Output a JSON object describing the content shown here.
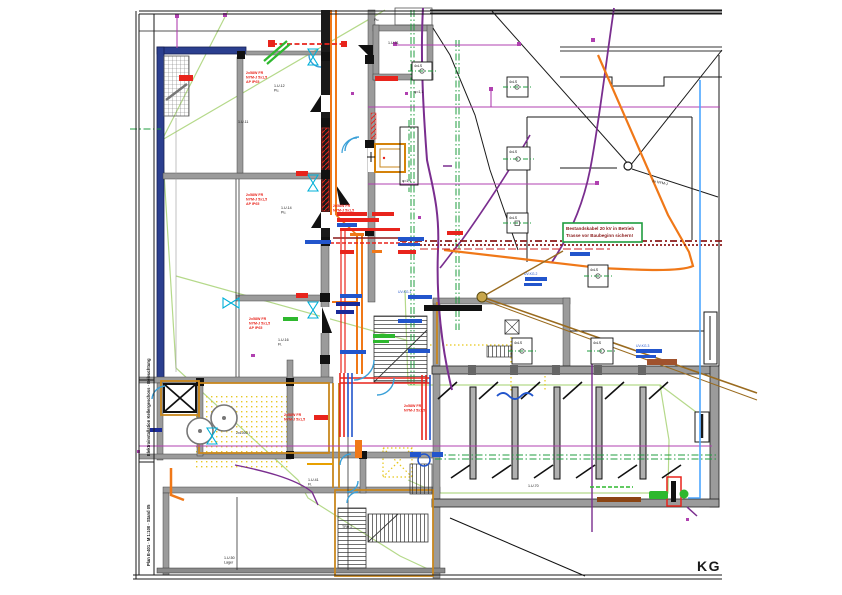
{
  "drawing": {
    "type": "CAD floor plan, electrical installation, basement",
    "floor_label": "KG"
  },
  "labels": {
    "kg": "KG",
    "sym": "4xLS",
    "phi": "φ=1,1",
    "rot_cable": "3x NYM-J",
    "red1": "2x58W FR",
    "red2": "NYM-J 5x1,5",
    "red3": "AP IP65",
    "blue1": "UV-KG.1",
    "blue2": "UV-KG.2",
    "blue3": "UV-KG.3",
    "r1": "1.U.12",
    "r1s": "Pu.",
    "r2": "1.U.11",
    "r3": "1.U.14",
    "r3s": "Pu.",
    "r4": "1.U.16",
    "r4s": "Fl.",
    "r5": "Pu.",
    "r6": "1.U.31",
    "r7": "1.U.41",
    "r7s": "Fl.",
    "r8": "1.U.50",
    "r8s": "Lager",
    "r9": "TRH 2",
    "r11": "1.U.70",
    "tank": "2x1000 l"
  },
  "note_box": {
    "line1": "Bestandskabel 20 kV in Betrieb",
    "line2": "Trasse vor Baubeginn sichern!"
  },
  "legend": {
    "block1": "Elektroinstallation Kellergeschoss · Beleuchtung",
    "block2": "Plan E-401 · M 1:100 · Stand 05"
  },
  "colors": {
    "wall": "#9b9b9b",
    "wall_dark": "#1a1a1a",
    "wall_blue": "#2b3f8f",
    "gold": "#c8871e",
    "orange": "#f07818",
    "magenta": "#b040b0",
    "purple": "#7a2e8f",
    "maroon": "#8b1a1a",
    "red": "#e8241c",
    "blue": "#2255cc",
    "navy": "#1a2a99",
    "sky": "#3aa0d8",
    "cyan": "#00b0d8",
    "green": "#1f9d3f",
    "green_bright": "#2eb82e",
    "green_pale": "#b5d98a",
    "yellow": "#e6c619",
    "brown": "#9a6b1f",
    "light_blue": "#4da6ff",
    "ink": "#1a1a1a"
  }
}
